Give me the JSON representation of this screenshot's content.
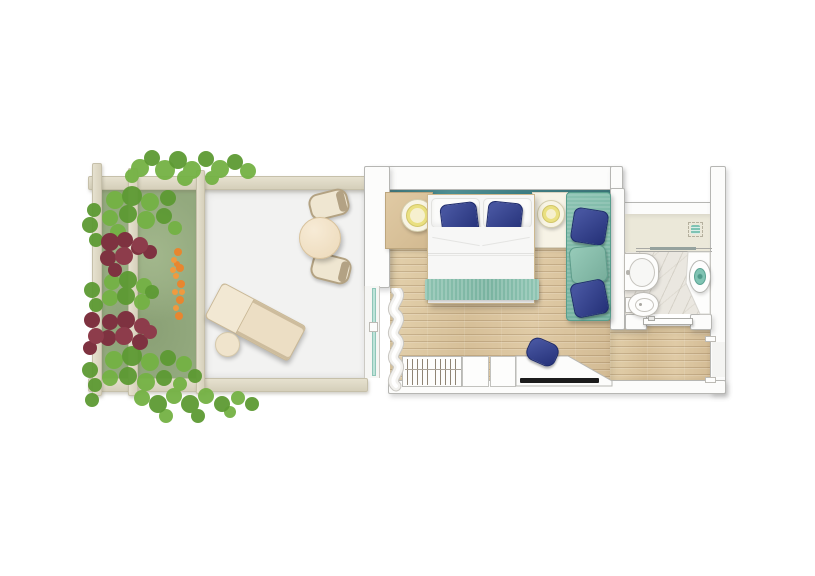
{
  "image_type": "top-down rendered floor plan of a hotel guest room with garden terrace; no visible text labels in the image",
  "palette": {
    "background": "#ffffff",
    "wall_fill": "#fcfcfb",
    "wall_border": "#b6b6b3",
    "pergola_beam": "#ded8c6",
    "terrace_floor": "#f2f2f1",
    "lawn_green": "#96ab81",
    "foliage_green": "#74b244",
    "foliage_dark_red": "#7e3240",
    "flower_orange": "#e8862f",
    "wood_floor": "#dcc6a0",
    "headboard_teal": "#35838a",
    "seafoam_textile": "#85bead",
    "cushion_blue": "#2c3c8e",
    "cream_furniture": "#efe0c4",
    "lamp_yellow": "#eae081",
    "accent_teal_fixture": "#7fc3b3",
    "marble_floor": "#eae7e0",
    "shower_floor": "#ebe8d9",
    "tv_black": "#1c1c1c",
    "glass_door_teal": "#bfe3d9"
  },
  "areas": [
    {
      "name": "garden-bed",
      "desc": "planted strip with green shrubs, two dark-red bushes, orange flower row and lawn"
    },
    {
      "name": "pergola-terrace",
      "desc": "white terrace framed by beige pergola beams"
    },
    {
      "name": "bedroom",
      "desc": "wood-floor bedroom with teal headboard band"
    },
    {
      "name": "bathroom",
      "desc": "marble bathroom with walk-in shower"
    },
    {
      "name": "entry-corridor",
      "desc": "wood corridor inside the entrance door"
    }
  ],
  "furniture": [
    "round dining table",
    "upper terrace chair",
    "lower terrace chair",
    "sun lounger",
    "round side table",
    "double bed with two white pillows, two blue cushions and seafoam runner",
    "left wooden nightstand with round lamp",
    "right cream nightstand with round lamp",
    "seafoam daybed with two blue cushions and one seafoam cushion",
    "wardrobe with hangers",
    "two storage cabinets",
    "desk console with black TV",
    "blue desk chair",
    "white curtain at sliding glass terrace door",
    "washbasin vanity",
    "bidet",
    "toilet on white platform",
    "shower drain",
    "glass shower screen",
    "sliding bathroom door",
    "entrance door opening in right wall"
  ]
}
